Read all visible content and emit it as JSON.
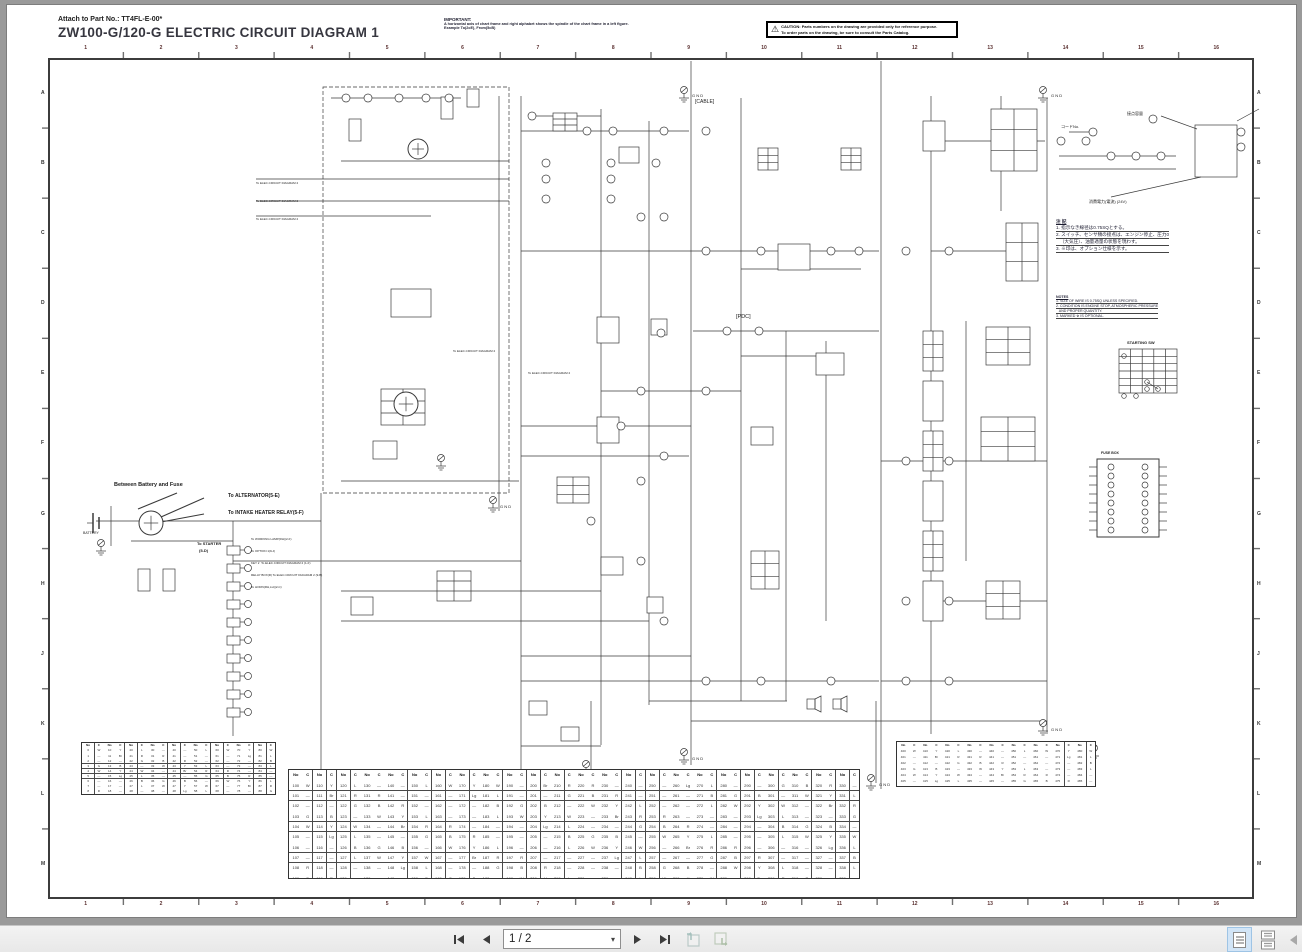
{
  "header": {
    "attach": "Attach to Part No.: TT4FL-E-00*",
    "title": "ZW100-G/120-G ELECTRIC CIRCUIT DIAGRAM 1"
  },
  "important": {
    "heading": "IMPORTANT:",
    "line1": "A horizontal axis of chart frame and right alphabet shows the spindle of the chart frame in a left figure.",
    "line2": "Example To(2cE), From(5cB)"
  },
  "caution": {
    "label": "CAUTION:",
    "line1": "Parts numbers on the drawing are provided only for reference purpose.",
    "line2": "To order parts on the drawing, be sure to consult the Parts Catalog."
  },
  "frame": {
    "top_numbers": [
      "1",
      "2",
      "3",
      "4",
      "5",
      "6",
      "7",
      "8",
      "9",
      "10",
      "11",
      "12",
      "13",
      "14",
      "15",
      "16"
    ],
    "side_letters": [
      "A",
      "B",
      "C",
      "D",
      "E",
      "F",
      "G",
      "H",
      "J",
      "K",
      "L",
      "M"
    ]
  },
  "labels": {
    "between": "Between Battery and Fuse",
    "to_alt": "To ALTERNATOR(5-E)",
    "to_ihr": "To INTAKE HEATER RELAY(5-F)",
    "to_starter": "To STARTER",
    "to_starter2": "(5-D)",
    "battery": "BATTERY",
    "cable": "[CABLE]",
    "pdc": "[PDC]",
    "gnd": "G N D",
    "fusebox": "FUSE BOX",
    "startsw": "STARTING SW",
    "code_no": "コードNo.",
    "contact": "接点容量",
    "power": "消費電力(電流) (24V)",
    "lamp": "To WORKING LAMP(RH)(2-F)",
    "opt1": "To OPTION 1(9-J)",
    "key2": "KEY 2  To ELEC.CIRCUIT DIAGRAM 2 (1-F)",
    "relaybox": "RELAY BOX(R) To ELEC.CIRCUIT DIAGRAM 2 (9-B)",
    "horn": "To HORN(RH,LH)(2-C)",
    "diag2": "To ELEC.CIRCUIT DIAGRAM 2"
  },
  "notes_jp": {
    "title": "注 記",
    "lines": [
      "1. 指示なき線径は0.75SQとする。",
      "2. スイッチ、センサ類の接点は、エンジン停止、圧力0",
      "   （大気圧）、油量適量の状態を現わす。",
      "3. ※印は、オプション仕様を示す。"
    ]
  },
  "notes_en": {
    "title": "NOTES",
    "lines": [
      "1. SIZE OF WIRE IS 0.75SQ UNLESS SPECIFIED.",
      "2. CONDITION IS ENGINE STOP, ATMOSPHERIC PRESSURE",
      "   AND PROPER QUANTITY.",
      "3. MARKED ※ IS OPTIONAL."
    ]
  },
  "tables": {
    "headers": {
      "no": "No",
      "c": "C"
    },
    "left": {
      "start": 0,
      "rows": 10,
      "pairs": 9
    },
    "center": {
      "start": 100,
      "rows": 10,
      "pairs": 24
    },
    "right": {
      "start": 400,
      "rows": 7,
      "pairs": 9
    },
    "colors": [
      "W",
      "—",
      "B",
      "—",
      "R",
      "L",
      "—",
      "Y",
      "—",
      "G",
      "Br",
      "—",
      "W",
      "—",
      "L",
      "—",
      "B",
      "R",
      "—",
      "Y",
      "G",
      "—",
      "Lg",
      "—",
      "R",
      "—",
      "W",
      "B",
      "—",
      "L"
    ]
  },
  "toolbar": {
    "page_display": "1 / 2"
  }
}
